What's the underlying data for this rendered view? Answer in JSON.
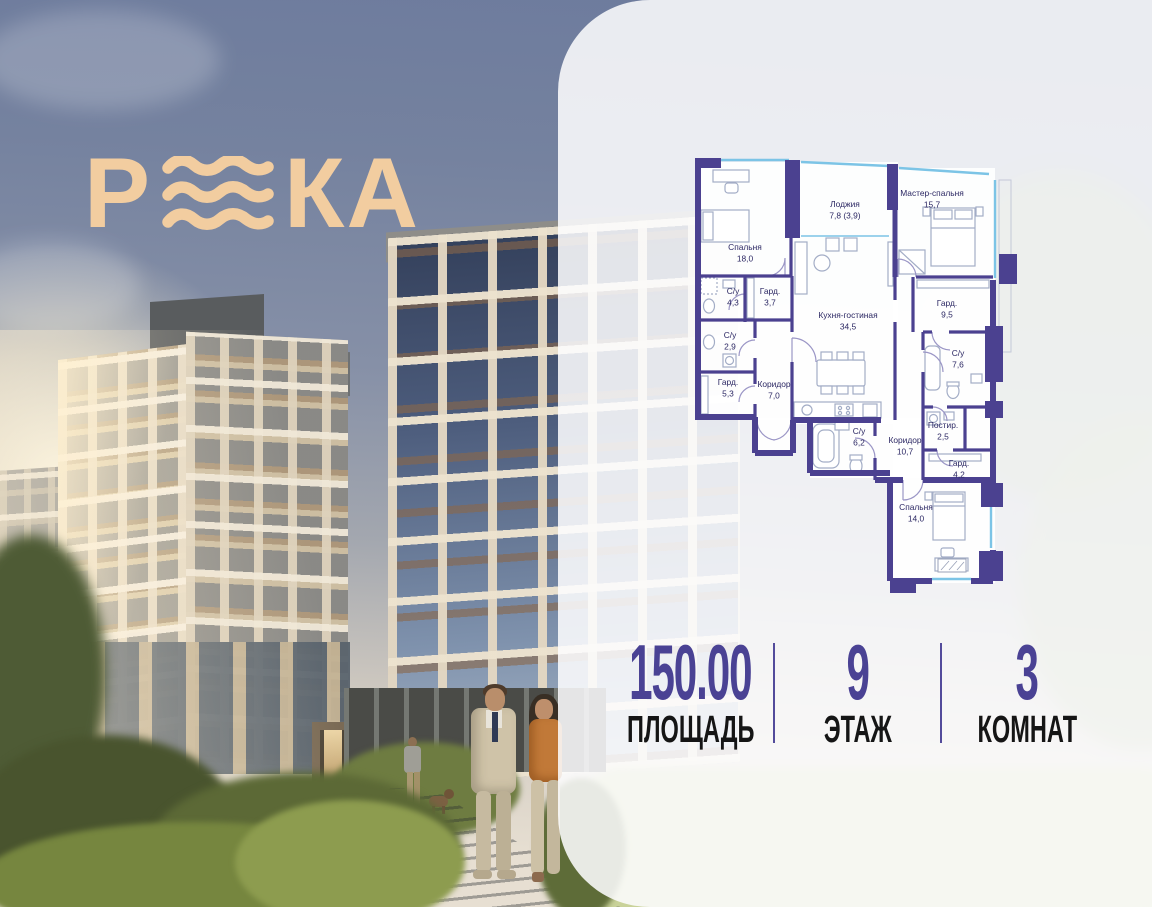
{
  "logo": {
    "letter_p": "Р",
    "letters_ka": "КА",
    "wave_icon": "three-waves",
    "color": "#F2CDA0"
  },
  "floor_plan": {
    "wall_color": "#4B4190",
    "window_color": "#7CC4E6",
    "label_color": "#2B2763",
    "rooms": [
      {
        "name": "Спальня",
        "area": "18,0"
      },
      {
        "name": "Лоджия",
        "area": "7,8 (3,9)"
      },
      {
        "name": "Мастер-спальня",
        "area": "15,7"
      },
      {
        "name": "Кухня-гостиная",
        "area": "34,5"
      },
      {
        "name": "С/у",
        "area": "4,3"
      },
      {
        "name": "Гард.",
        "area": "3,7"
      },
      {
        "name": "С/у",
        "area": "2,9"
      },
      {
        "name": "Гард.",
        "area": "5,3"
      },
      {
        "name": "Коридор",
        "area": "7,0"
      },
      {
        "name": "Гард.",
        "area": "9,5"
      },
      {
        "name": "С/у",
        "area": "7,6"
      },
      {
        "name": "С/у",
        "area": "6,2"
      },
      {
        "name": "Коридор",
        "area": "10,7"
      },
      {
        "name": "Постир.",
        "area": "2,5"
      },
      {
        "name": "Гард.",
        "area": "4,2"
      },
      {
        "name": "Спальня",
        "area": "14,0"
      }
    ]
  },
  "stats": {
    "value_color": "#4A4294",
    "items": [
      {
        "value": "150.00",
        "label": "ПЛОЩАДЬ"
      },
      {
        "value": "9",
        "label": "ЭТАЖ"
      },
      {
        "value": "3",
        "label": "КОМНАТ"
      }
    ]
  }
}
